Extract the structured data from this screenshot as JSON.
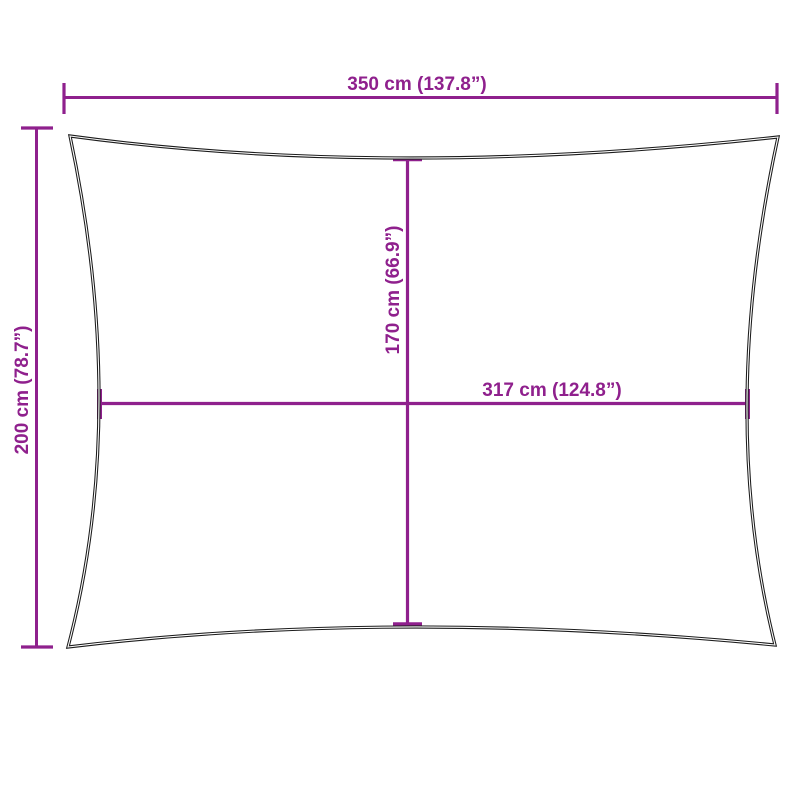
{
  "diagram": {
    "dimensions": {
      "width_top": {
        "label": "350 cm (137.8”)",
        "cm": "350",
        "inches": "137.8"
      },
      "height_left": {
        "label": "200 cm (78.7”)",
        "cm": "200",
        "inches": "78.7"
      },
      "height_center": {
        "label": "170 cm (66.9”)",
        "cm": "170",
        "inches": "66.9"
      },
      "width_center": {
        "label": "317 cm (124.8”)",
        "cm": "317",
        "inches": "124.8"
      }
    }
  },
  "colors": {
    "dimension_accent": "#8F208D",
    "sail_outline": "#1C1C1C",
    "background": "#FFFFFF"
  }
}
